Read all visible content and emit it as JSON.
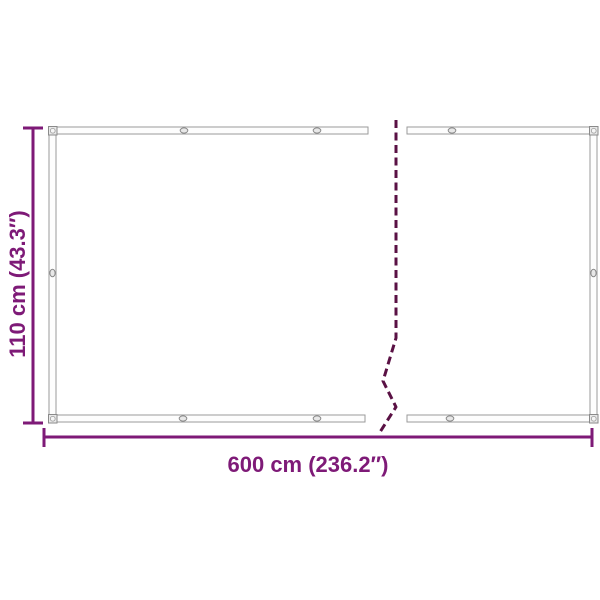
{
  "diagram": {
    "kind": "product-dimension-diagram",
    "subject": "privacy screen / net panel with grommets, drawn with a break to indicate continued length",
    "measurements": {
      "width": {
        "label": "600 cm (236.2″)"
      },
      "height": {
        "label": "110 cm (43.3″)"
      }
    },
    "colors": {
      "background": "#ffffff",
      "dimension_accent": "#7e1a77",
      "break_line": "#5a1144",
      "frame_outline": "#9a9a9a",
      "grommet_fill": "#e8e8e8"
    }
  }
}
